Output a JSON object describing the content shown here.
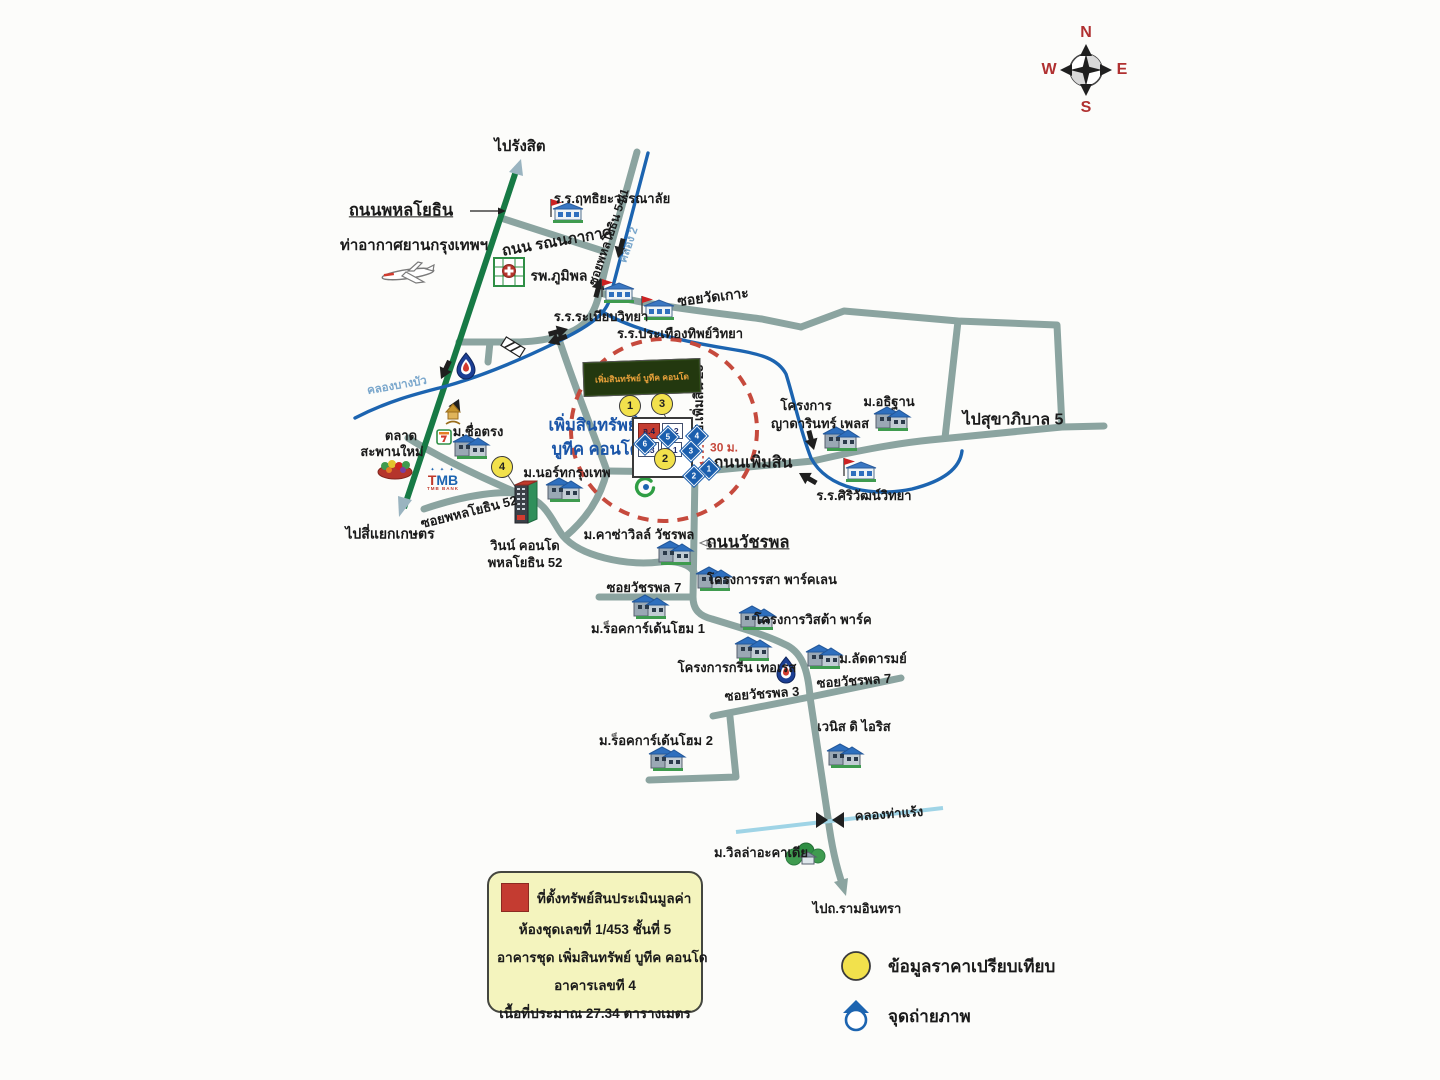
{
  "colors": {
    "road": "#8ba4a0",
    "road_green": "#177a45",
    "canal": "#1c64b0",
    "canal_light": "#9fd4e6",
    "circle_red": "#c64a3d",
    "marker_yellow": "#f2e14c",
    "camera_blue": "#1b5fae",
    "legend_bg": "#f4f4be",
    "subject_red": "#c43c31",
    "property_text_blue": "#1a55a8",
    "compass_red": "#b03030"
  },
  "compass": {
    "n": "N",
    "e": "E",
    "s": "S",
    "w": "W"
  },
  "banner": {
    "text": "เพิ่มสินทรัพย์ บูทีค คอนโด"
  },
  "tmb": {
    "stars": "✦ ✦ ✦",
    "line1": "TMB",
    "line2": "TMB BANK"
  },
  "property": {
    "blocks": [
      {
        "label": "อ.4",
        "x": 4,
        "y": 4,
        "w": 20,
        "h": 14,
        "subject": true
      },
      {
        "label": "อ.2",
        "x": 28,
        "y": 4,
        "w": 19,
        "h": 14,
        "subject": false
      },
      {
        "label": "อ.3",
        "x": 4,
        "y": 23,
        "w": 19,
        "h": 13,
        "subject": false
      },
      {
        "label": "อ.1",
        "x": 27,
        "y": 23,
        "w": 19,
        "h": 13,
        "subject": false
      }
    ]
  },
  "legend_box": {
    "lines": [
      "ที่ตั้งทรัพย์สินประเมินมูลค่า",
      "ห้องชุดเลขที่ 1/453  ชั้นที่  5",
      "อาคารชุด เพิ่มสินทรัพย์ บูทีค คอนโด",
      "อาคารเลขที  4",
      "เนื้อที่ประมาณ 27.34  ตารางเมตร"
    ]
  },
  "legend_items": [
    {
      "symbol": "yellow-circle",
      "label": "ข้อมูลราคาเปรียบเทียบ"
    },
    {
      "symbol": "camera-point",
      "label": "จุดถ่ายภาพ"
    }
  ],
  "map": {
    "labels": [
      {
        "text": "ไปรังสิต",
        "x": 520,
        "y": 147,
        "rot": 0,
        "cls": "lbl-15",
        "name": "dest-rangsit"
      },
      {
        "text": "ถนนพหลโยธิน",
        "x": 401,
        "y": 211,
        "rot": 0,
        "cls": "road-major",
        "name": "phahonyothin-road-label"
      },
      {
        "text": "ท่าอากาศยานกรุงเทพฯ",
        "x": 414,
        "y": 246,
        "rot": 0,
        "cls": "lbl-15",
        "name": "bangkok-airport-label"
      },
      {
        "text": "รพ.ภูมิพล",
        "x": 559,
        "y": 276,
        "rot": 0,
        "cls": "lbl-14",
        "name": "bhumibol-hospital-label"
      },
      {
        "text": "ร.ร.ฤทธิยะวรรณาลัย",
        "x": 612,
        "y": 199,
        "rot": 0,
        "cls": "lbl-13",
        "name": "ritthiya-school-label"
      },
      {
        "text": "ถนน รณนภากาศ",
        "x": 557,
        "y": 242,
        "rot": -10,
        "cls": "lbl-15",
        "name": "ronnaphakat-road-label"
      },
      {
        "text": "ซอยพหลโยธิน 54/1",
        "x": 609,
        "y": 237,
        "rot": -71,
        "cls": "lbl-12",
        "name": "soi-phahonyothin-54-1-label"
      },
      {
        "text": "คลอง 2",
        "x": 629,
        "y": 245,
        "rot": -71,
        "cls": "lbl-11 canal-faint",
        "name": "khlong-2-label"
      },
      {
        "text": "ซอยวัดเกาะ",
        "x": 713,
        "y": 297,
        "rot": -7,
        "cls": "lbl-14",
        "name": "soi-wat-ko-label"
      },
      {
        "text": "ร.ร.ระเบียบวิทยา",
        "x": 601,
        "y": 317,
        "rot": 0,
        "cls": "lbl-13",
        "name": "rabiab-school-label"
      },
      {
        "text": "ร.ร.ประเทืองทิพย์วิทยา",
        "x": 680,
        "y": 334,
        "rot": 0,
        "cls": "lbl-13",
        "name": "prathuangthip-school-label"
      },
      {
        "text": "ม.อธิฐาน",
        "x": 889,
        "y": 402,
        "rot": 0,
        "cls": "lbl-13",
        "name": "mu-athithan-label"
      },
      {
        "text": "โครงการ",
        "x": 806,
        "y": 406,
        "rot": 0,
        "cls": "lbl-13",
        "name": "yadarin-place-label-1"
      },
      {
        "text": "ญาดารินทร์ เพลส",
        "x": 820,
        "y": 424,
        "rot": 0,
        "cls": "lbl-13",
        "name": "yadarin-place-label-2"
      },
      {
        "text": "ไปสุขาภิบาล 5",
        "x": 1013,
        "y": 421,
        "rot": 0,
        "cls": "lbl-16",
        "name": "dest-sukhaphiban-5"
      },
      {
        "text": "ร.ร.ศิริวัฒน์วิทยา",
        "x": 864,
        "y": 496,
        "rot": 0,
        "cls": "lbl-13",
        "name": "siriwat-school-label"
      },
      {
        "text": "ถนนเพิ่มสิน",
        "x": 753,
        "y": 464,
        "rot": 0,
        "cls": "lbl-16",
        "name": "phoemsin-road-label"
      },
      {
        "text": "ซ.เพิ่มสิน 23",
        "x": 699,
        "y": 399,
        "rot": -90,
        "cls": "lbl-13",
        "name": "soi-phoemsin-23-label"
      },
      {
        "text": "30 ม.",
        "x": 724,
        "y": 448,
        "rot": 0,
        "cls": "red-small",
        "name": "distance-30m-label"
      },
      {
        "text": "เพิ่มสินทรัพย์",
        "x": 593,
        "y": 426,
        "rot": 0,
        "cls": "blue-16",
        "name": "property-name-line1"
      },
      {
        "text": "บูทีค คอนโด",
        "x": 596,
        "y": 450,
        "rot": 0,
        "cls": "blue-16",
        "name": "property-name-line2"
      },
      {
        "text": "คลองบางบัว",
        "x": 397,
        "y": 386,
        "rot": -10,
        "cls": "canal-faint",
        "name": "khlong-bangbua-label"
      },
      {
        "text": "ตลาด",
        "x": 401,
        "y": 436,
        "rot": 0,
        "cls": "lbl-13",
        "name": "saphanmai-market-label-1"
      },
      {
        "text": "สะพานใหม่",
        "x": 392,
        "y": 452,
        "rot": 0,
        "cls": "lbl-13",
        "name": "saphanmai-market-label-2"
      },
      {
        "text": "ม.ชื่อตรง",
        "x": 478,
        "y": 432,
        "rot": 0,
        "cls": "lbl-13",
        "name": "mu-chuetrong-label"
      },
      {
        "text": "ม.นอร์ทกรุงเทพ",
        "x": 567,
        "y": 473,
        "rot": 0,
        "cls": "lbl-13",
        "name": "mu-north-bangkok-label"
      },
      {
        "text": "ซอยพหลโยธิน 52",
        "x": 469,
        "y": 512,
        "rot": -14,
        "cls": "lbl-13",
        "name": "soi-phahonyothin-52-label"
      },
      {
        "text": "ไปสี่แยกเกษตร",
        "x": 390,
        "y": 534,
        "rot": 0,
        "cls": "lbl-14",
        "name": "dest-kaset-intersection"
      },
      {
        "text": "วินน์ คอนโด",
        "x": 525,
        "y": 546,
        "rot": 0,
        "cls": "lbl-13",
        "name": "wynn-condo-label-1"
      },
      {
        "text": "พหลโยธิน 52",
        "x": 525,
        "y": 563,
        "rot": 0,
        "cls": "lbl-13",
        "name": "wynn-condo-label-2"
      },
      {
        "text": "ม.คาซ่าวิลล์ วัชรพล",
        "x": 639,
        "y": 535,
        "rot": 0,
        "cls": "lbl-13",
        "name": "mu-casa-ville-label"
      },
      {
        "text": "ถนนวัชรพล",
        "x": 748,
        "y": 543,
        "rot": 0,
        "cls": "road-major",
        "name": "watcharaphon-road-label"
      },
      {
        "text": "ซอยวัชรพล 7",
        "x": 644,
        "y": 588,
        "rot": 0,
        "cls": "lbl-13",
        "name": "soi-watcharaphon-7-label-a"
      },
      {
        "text": "โครงการรสา พาร์คเลน",
        "x": 772,
        "y": 580,
        "rot": 0,
        "cls": "lbl-13",
        "name": "rasa-parklane-label"
      },
      {
        "text": "ม.ร็อคการ์เด้นโฮม 1",
        "x": 648,
        "y": 629,
        "rot": 0,
        "cls": "lbl-13",
        "name": "rock-garden-home-1-label"
      },
      {
        "text": "โครงการวิสต้า พาร์ค",
        "x": 813,
        "y": 620,
        "rot": 0,
        "cls": "lbl-13",
        "name": "vista-park-label"
      },
      {
        "text": "โครงการกรีน เทอเรส",
        "x": 737,
        "y": 668,
        "rot": 0,
        "cls": "lbl-13",
        "name": "green-terrace-label"
      },
      {
        "text": "ม.ลัดดารมย์",
        "x": 873,
        "y": 659,
        "rot": 0,
        "cls": "lbl-13",
        "name": "mu-laddarom-label"
      },
      {
        "text": "ซอยวัชรพล 3",
        "x": 762,
        "y": 694,
        "rot": -4,
        "cls": "lbl-13",
        "name": "soi-watcharaphon-3-label"
      },
      {
        "text": "ซอยวัชรพล 7",
        "x": 854,
        "y": 681,
        "rot": -4,
        "cls": "lbl-13",
        "name": "soi-watcharaphon-7-label-b"
      },
      {
        "text": "เวนิส ดิ ไอริส",
        "x": 854,
        "y": 727,
        "rot": 0,
        "cls": "lbl-13",
        "name": "venice-di-iris-label"
      },
      {
        "text": "ม.ร็อคการ์เด้นโฮม 2",
        "x": 656,
        "y": 741,
        "rot": 0,
        "cls": "lbl-13",
        "name": "rock-garden-home-2-label"
      },
      {
        "text": "คลองท่าแร้ง",
        "x": 889,
        "y": 814,
        "rot": -4,
        "cls": "lbl-13",
        "name": "khlong-tharaeng-label"
      },
      {
        "text": "ม.วิลล่าอะคาเดีย",
        "x": 761,
        "y": 853,
        "rot": 0,
        "cls": "lbl-13",
        "name": "villa-acadia-label"
      },
      {
        "text": "ไปถ.รามอินทรา",
        "x": 857,
        "y": 909,
        "rot": 0,
        "cls": "lbl-13",
        "name": "dest-ramintra"
      }
    ],
    "price_points": [
      {
        "n": "1",
        "x": 630,
        "y": 406
      },
      {
        "n": "3",
        "x": 662,
        "y": 404
      },
      {
        "n": "2",
        "x": 665,
        "y": 459
      },
      {
        "n": "4",
        "x": 502,
        "y": 467
      }
    ],
    "camera_points": [
      {
        "n": "6",
        "x": 645,
        "y": 444
      },
      {
        "n": "5",
        "x": 668,
        "y": 437
      },
      {
        "n": "4",
        "x": 697,
        "y": 436
      },
      {
        "n": "3",
        "x": 691,
        "y": 451
      },
      {
        "n": "1",
        "x": 709,
        "y": 469
      },
      {
        "n": "2",
        "x": 694,
        "y": 476
      }
    ],
    "icons": [
      {
        "type": "airplane-icon",
        "x": 408,
        "y": 274
      },
      {
        "type": "hospital-icon",
        "x": 509,
        "y": 272
      },
      {
        "type": "school-icon",
        "x": 567,
        "y": 217
      },
      {
        "type": "school-icon",
        "x": 618,
        "y": 297
      },
      {
        "type": "school-icon",
        "x": 658,
        "y": 314
      },
      {
        "type": "school-icon",
        "x": 860,
        "y": 476
      },
      {
        "type": "village-icon",
        "x": 472,
        "y": 451
      },
      {
        "type": "village-icon",
        "x": 893,
        "y": 423
      },
      {
        "type": "village-icon",
        "x": 842,
        "y": 443
      },
      {
        "type": "village-icon",
        "x": 676,
        "y": 557
      },
      {
        "type": "village-icon",
        "x": 715,
        "y": 583
      },
      {
        "type": "village-icon",
        "x": 651,
        "y": 611
      },
      {
        "type": "village-icon",
        "x": 758,
        "y": 622
      },
      {
        "type": "village-icon",
        "x": 754,
        "y": 653
      },
      {
        "type": "village-icon",
        "x": 825,
        "y": 661
      },
      {
        "type": "village-icon",
        "x": 846,
        "y": 760
      },
      {
        "type": "village-icon",
        "x": 668,
        "y": 763
      },
      {
        "type": "village-icon",
        "x": 565,
        "y": 494
      },
      {
        "type": "seven-eleven-icon",
        "x": 444,
        "y": 437
      },
      {
        "type": "shrine-icon",
        "x": 453,
        "y": 416
      },
      {
        "type": "market-icon",
        "x": 395,
        "y": 469
      },
      {
        "type": "ptt-station-icon",
        "x": 466,
        "y": 365
      },
      {
        "type": "ptt-station-icon",
        "x": 786,
        "y": 669
      },
      {
        "type": "ptt-logo-icon",
        "x": 645,
        "y": 487
      },
      {
        "type": "wynn-tower-icon",
        "x": 524,
        "y": 505
      },
      {
        "type": "villa-green-icon",
        "x": 806,
        "y": 855
      }
    ]
  }
}
